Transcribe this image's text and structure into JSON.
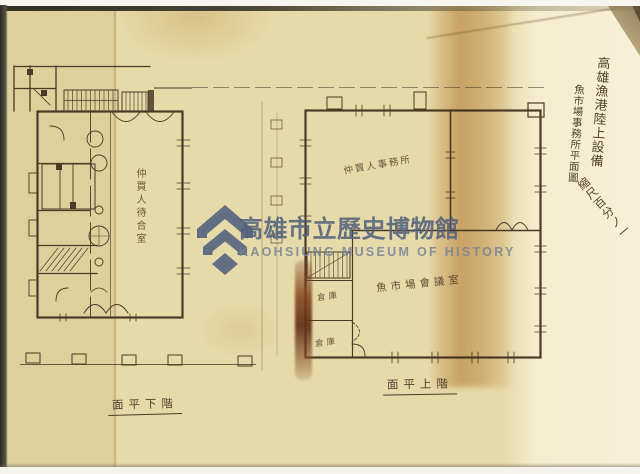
{
  "watermark": {
    "name_cjk": "高雄市立歷史博物館",
    "name_en": "KAOHSIUNG MUSEUM OF HISTORY",
    "color": "#4a5b7c"
  },
  "title_block": {
    "line1": "高雄漁港陸上設備",
    "line2": "魚市場事務所平面圖",
    "line3": "縮尺百分ノ一"
  },
  "plans": {
    "lower": {
      "caption": "面平下階",
      "hall_label": "仲買人待合室"
    },
    "upper": {
      "caption": "面平上階",
      "office_label": "仲買人事務所",
      "meeting_label": "魚市場會議室",
      "storage1_label": "倉庫",
      "storage2_label": "倉庫"
    }
  },
  "colors": {
    "paper": "#e7daa9",
    "paper_light": "#f1e8cd",
    "stain": "#d2b27c",
    "ink": "#4a3926",
    "tape_stain": "#7c4523"
  }
}
